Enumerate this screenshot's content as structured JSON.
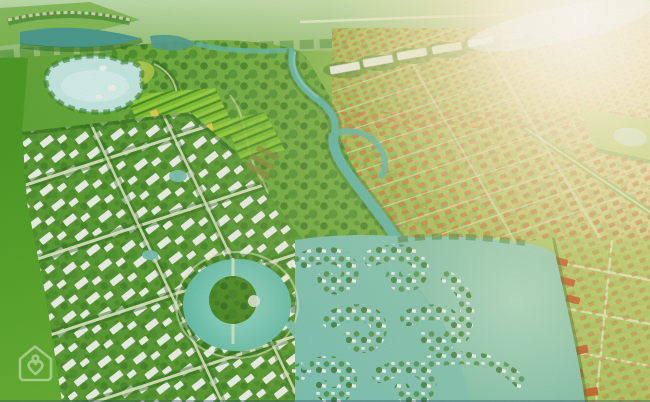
{
  "scene": {
    "title": "Aerial masterplan rendering of a lakeside residential community",
    "type": "architectural-render-birdseye",
    "canvas": {
      "width": 650,
      "height": 402
    }
  },
  "watermark": {
    "icon": "house-heart-icon",
    "color": "#ffffff",
    "opacity": 0.42
  },
  "colors": {
    "base_left": "#61a637",
    "base_mid": "#79b447",
    "base_right": "#a5c95e",
    "base_sun": "#cdd373",
    "haze_top": "#c6e2b4",
    "haze_bottom": "#93c173",
    "field_dark": "#4f9e27",
    "field_light": "#68b136",
    "park_green": "#6fae3d",
    "district_green": "#5d9f36",
    "villa_green": "#4f9e2a",
    "tree_dark": "#2f6e1e",
    "tree_mid": "#3f8426",
    "lake_pale": "#c7ebe3",
    "lake_inner": "#def5ef",
    "pond_dark": "#4f9d90",
    "river_teal": "#5cb5a7",
    "river_light": "#8fd4c8",
    "channel_teal": "#7cc4b4",
    "lake_big_light": "#a7dac6",
    "lake_big": "#86c8b2",
    "lake_big_deep": "#6fb89e",
    "white_roof": "#f4f7f1",
    "roof_shadow": "#8d9c64",
    "orange_roof": "#c97f3c",
    "orange_roof_light": "#dfa05e",
    "orange_deep": "#c4551e",
    "lawn_light": "#96c24e",
    "lawn_sun": "#c2d470",
    "garden_bright": "#93d23e",
    "garden_dark": "#4c8c1f",
    "garden_mid": "#7fc232",
    "golf_light": "#cbd96a",
    "golf_green": "#9dc23f",
    "golf_yellow": "#d8d44e",
    "olive_building": "#8a8a3a",
    "road_light": "#e4ecc6",
    "building_white": "#eef2e6",
    "sun_core": "#fffdf4",
    "sun_warm": "#f7ecb8",
    "sand": "#e8dc9a"
  },
  "regions": {
    "labels": [
      "distant-fields",
      "upper-lake",
      "garden-plots",
      "central-park",
      "river",
      "white-villa-district",
      "island-pond",
      "villa-peninsulas",
      "grand-lake",
      "orange-house-district",
      "lakeside-lawns",
      "sun-flare",
      "watermark"
    ]
  }
}
